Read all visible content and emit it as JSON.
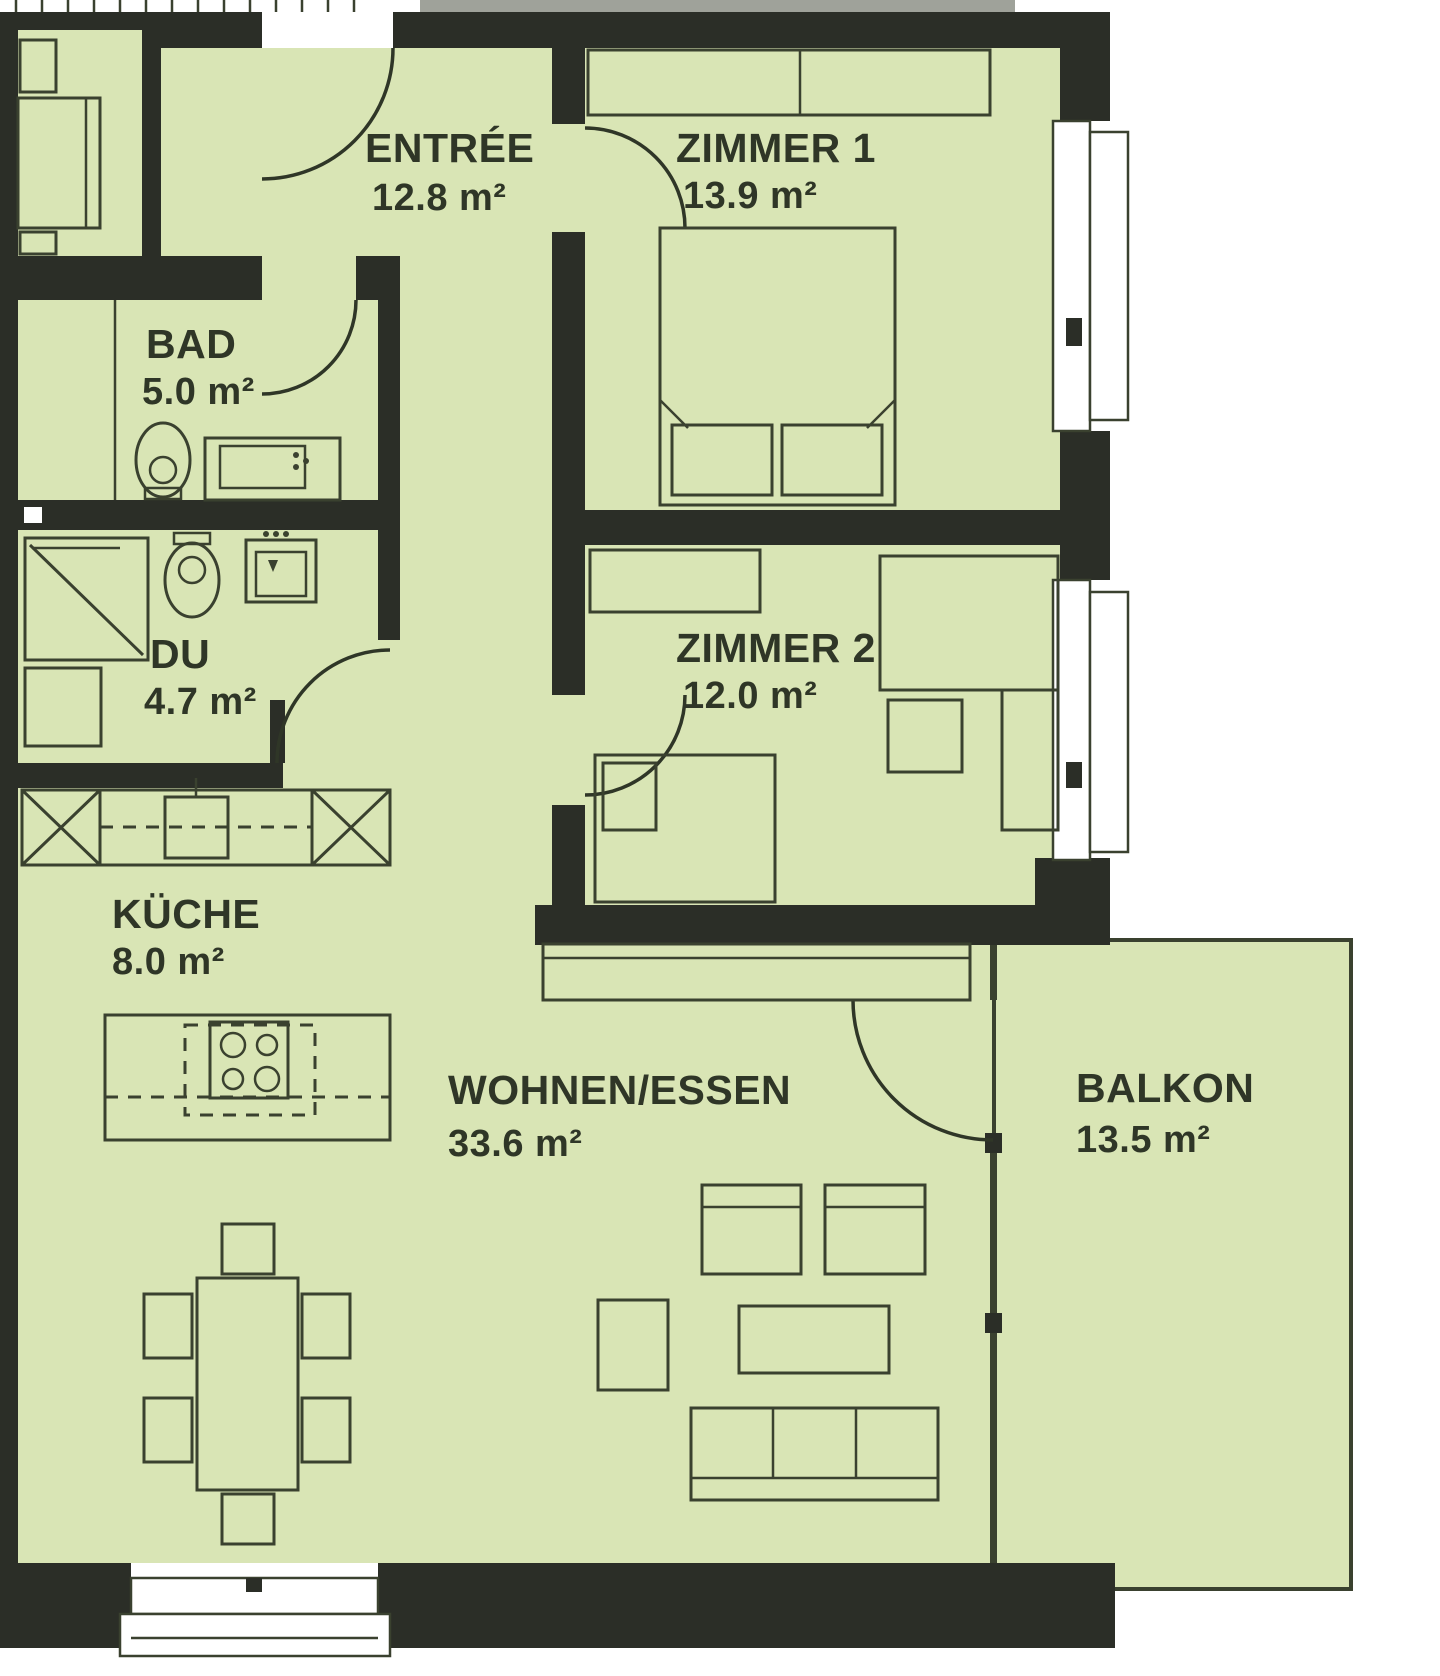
{
  "plan": {
    "colors": {
      "floor": "#d9e5b5",
      "wall": "#2b2e27",
      "furniture_line": "#3a412f",
      "adjacent_grey": "#9fa29a",
      "text": "#2f3627"
    },
    "rooms": [
      {
        "id": "entree",
        "name": "ENTRÉE",
        "area": "12.8 m²"
      },
      {
        "id": "zimmer1",
        "name": "ZIMMER 1",
        "area": "13.9 m²"
      },
      {
        "id": "bad",
        "name": "BAD",
        "area": "5.0 m²"
      },
      {
        "id": "du",
        "name": "DU",
        "area": "4.7 m²"
      },
      {
        "id": "zimmer2",
        "name": "ZIMMER 2",
        "area": "12.0 m²"
      },
      {
        "id": "kueche",
        "name": "KÜCHE",
        "area": "8.0 m²"
      },
      {
        "id": "wohnen",
        "name": "WOHNEN/ESSEN",
        "area": "33.6 m²"
      },
      {
        "id": "balkon",
        "name": "BALKON",
        "area": "13.5 m²"
      }
    ]
  }
}
